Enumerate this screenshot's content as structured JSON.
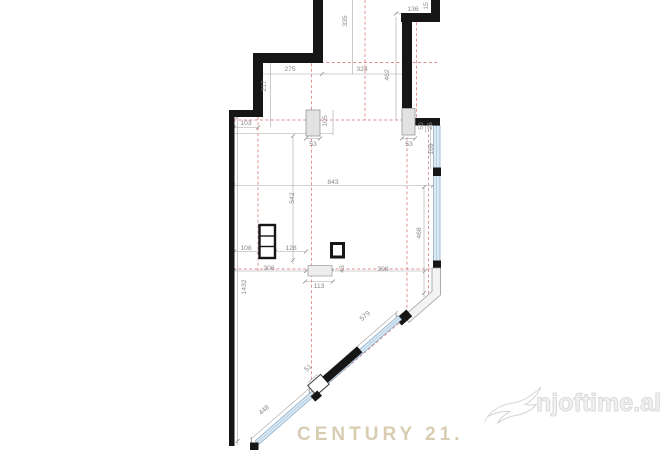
{
  "watermark": {
    "brand": "CENTURY 21.",
    "logo_text": "njoftime.al"
  },
  "floorplan": {
    "type": "apartment-floor-plan",
    "dimensions": [
      "335",
      "136",
      "15",
      "275",
      "324",
      "462",
      "217",
      "103",
      "105",
      "53",
      "53",
      "50",
      "26",
      "169",
      "843",
      "542",
      "468",
      "108",
      "128",
      "306",
      "43",
      "398",
      "113",
      "1432",
      "579",
      "51",
      "448"
    ],
    "colors": {
      "wall": "#161616",
      "axis_red": "#d4696b",
      "dimension_gray": "#9a9a9a",
      "window_fill": "#dbe9f5",
      "window_frame": "#8fb0ca",
      "column_fill": "#e2e2e2",
      "brand_beige": "#d8cdb3",
      "logo_gray": "#d9d9d9"
    }
  }
}
